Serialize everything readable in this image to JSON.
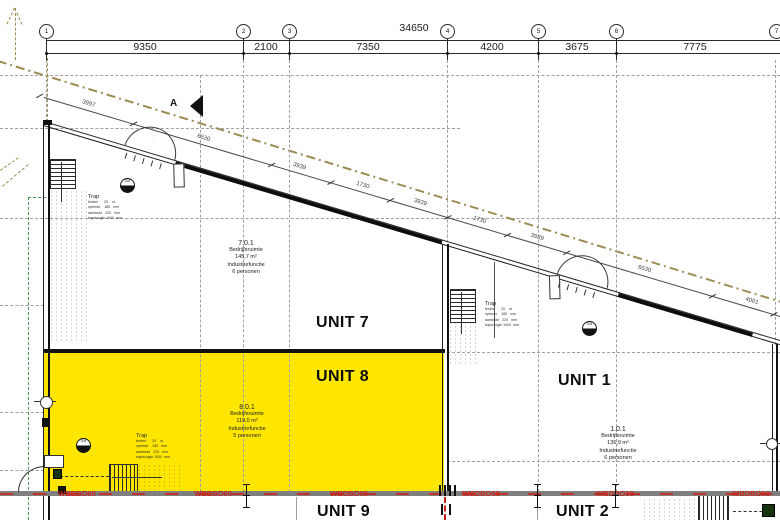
{
  "colors": {
    "highlight_yellow": "#ffe600",
    "fire_red": "#c8231c",
    "grid_gray": "#9f9f9f",
    "boundary_olive": "#9c8b52",
    "survey_green": "#4c9a57",
    "bottom_wall_gray": "#7f7f7f"
  },
  "top_dimensions": {
    "total": "34650",
    "segments": [
      "9350",
      "2100",
      "7350",
      "4200",
      "3675",
      "7775"
    ],
    "grid_bubbles": [
      "1",
      "2",
      "3",
      "4",
      "5",
      "6",
      "7"
    ]
  },
  "diagonal_dimensions": [
    "3997",
    "6530",
    "3939",
    "1730",
    "3939",
    "1730",
    "3939",
    "6530",
    "4001"
  ],
  "section_marker": "A",
  "units": {
    "unit7": {
      "label": "UNIT 7",
      "code": "7.0.1",
      "type": "Bedrijfsruimte",
      "area": "145,7 m²",
      "function": "Industriefunctie",
      "occupancy": "6 personen"
    },
    "unit8": {
      "label": "UNIT 8",
      "code": "8.0.1",
      "type": "Bedrijfsruimte",
      "area": "119,0 m²",
      "function": "Industriefunctie",
      "occupancy": "5 personen"
    },
    "unit1": {
      "label": "UNIT 1",
      "code": "1.0.1",
      "type": "Bedrijfsruimte",
      "area": "136,9 m²",
      "function": "Industriefunctie",
      "occupancy": "6 personen"
    },
    "unit9": {
      "label": "UNIT 9"
    },
    "unit2": {
      "label": "UNIT 2"
    }
  },
  "stairs": {
    "label": "Trap",
    "table": [
      "treden      20    st",
      "optrede    185   mm",
      "aantrede   220   mm",
      "traphoogte 1000  mm"
    ]
  },
  "fire_separation": {
    "label": "WBDBO60"
  },
  "symbols": {
    "meter": "GM"
  }
}
